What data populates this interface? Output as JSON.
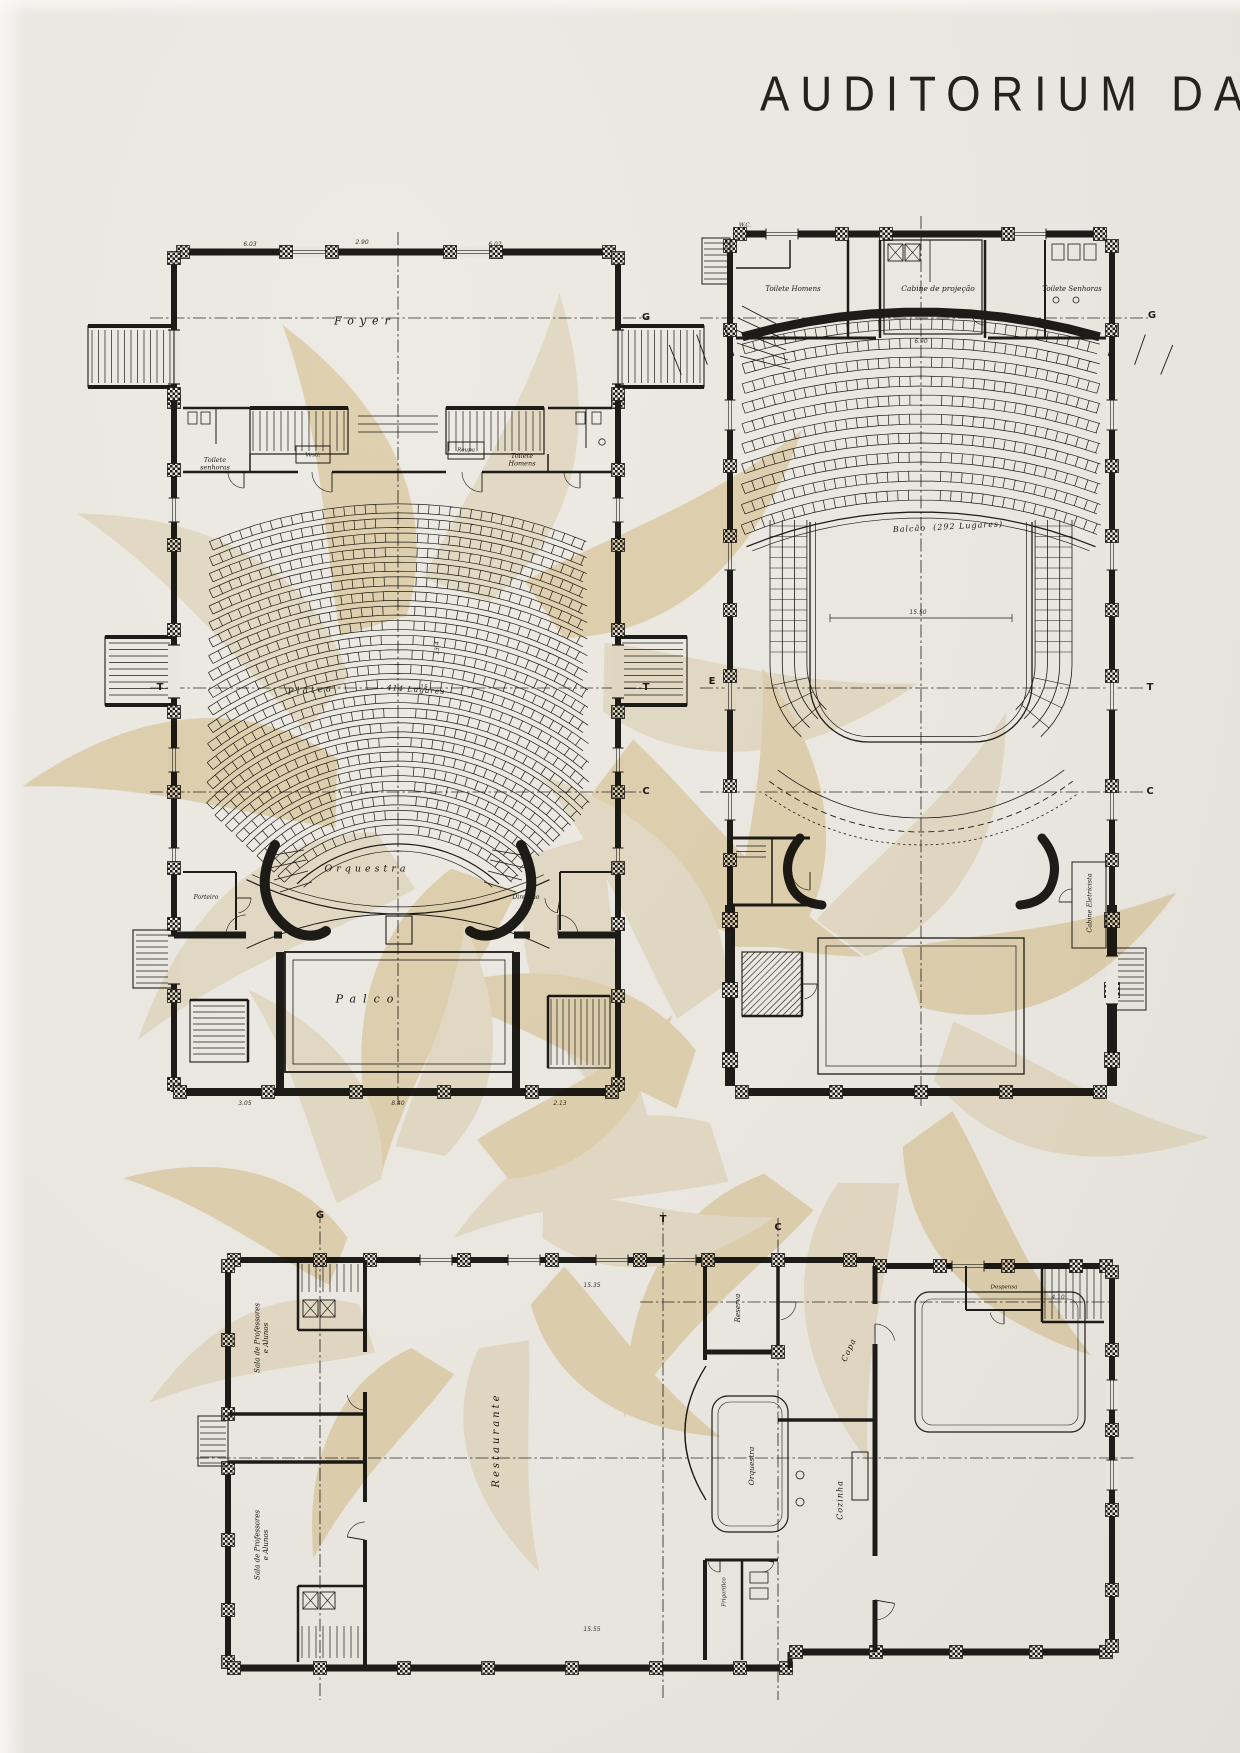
{
  "title": "AUDITORIUM DA",
  "colors": {
    "paper": "#e9e6e0",
    "ink": "#1d1c18",
    "section_line": "#2c2b26",
    "watermark_tan": "#efe1bf",
    "watermark_tan_light": "#f5edd9"
  },
  "plans": {
    "plan1": {
      "name": "planta-da-plateia",
      "labels": [
        {
          "id": "label-foyer",
          "t": "Foyer",
          "x": 365,
          "y": 322,
          "s": 11,
          "r": 0,
          "ls": 6
        },
        {
          "id": "label-toilete-senhoras",
          "t": "Toilete\nsenhoras",
          "x": 215,
          "y": 464,
          "s": 6.5,
          "r": 0,
          "ls": 0
        },
        {
          "id": "label-vesti",
          "t": "Vesti.",
          "x": 313,
          "y": 455,
          "s": 5.5,
          "r": 0,
          "ls": 0
        },
        {
          "id": "label-roupa",
          "t": "Roupa",
          "x": 466,
          "y": 450,
          "s": 5.5,
          "r": 0,
          "ls": 0
        },
        {
          "id": "label-toilete-homens",
          "t": "Toilete\nHomens",
          "x": 522,
          "y": 460,
          "s": 6.5,
          "r": 0,
          "ls": 0
        },
        {
          "id": "label-platea",
          "t": "Platea",
          "x": 311,
          "y": 691,
          "s": 9,
          "r": -4,
          "ls": 3
        },
        {
          "id": "label-platea-lugares",
          "t": "414 Lugares",
          "x": 416,
          "y": 690,
          "s": 7.5,
          "r": 4,
          "ls": 1
        },
        {
          "id": "label-orquestra",
          "t": "Orquestra",
          "x": 367,
          "y": 869,
          "s": 9.5,
          "r": 0,
          "ls": 4
        },
        {
          "id": "label-porteiro",
          "t": "Porteiro",
          "x": 206,
          "y": 897,
          "s": 6,
          "r": 0,
          "ls": 0
        },
        {
          "id": "label-direccao",
          "t": "Direcção",
          "x": 526,
          "y": 897,
          "s": 6,
          "r": 0,
          "ls": 0
        },
        {
          "id": "label-palco",
          "t": "Palco",
          "x": 368,
          "y": 1000,
          "s": 11,
          "r": 0,
          "ls": 7
        }
      ]
    },
    "plan2": {
      "name": "planta-do-balcao",
      "labels": [
        {
          "id": "label-wc",
          "t": "W.C.",
          "x": 745,
          "y": 225,
          "s": 5.5,
          "r": 0,
          "ls": 0
        },
        {
          "id": "label-toilete-homens-2",
          "t": "Toilete Homens",
          "x": 793,
          "y": 289,
          "s": 7,
          "r": 0,
          "ls": 0
        },
        {
          "id": "label-cabine-projecao",
          "t": "Cabine de projeção",
          "x": 938,
          "y": 289,
          "s": 7.5,
          "r": 0,
          "ls": 0
        },
        {
          "id": "label-toilete-senhoras-2",
          "t": "Toilete Senhoras",
          "x": 1072,
          "y": 289,
          "s": 7,
          "r": 0,
          "ls": 0
        },
        {
          "id": "label-balcao",
          "t": "Balcão  (292 Lugares)",
          "x": 948,
          "y": 527,
          "s": 8,
          "r": -3,
          "ls": 1
        },
        {
          "id": "label-cabine-eletricista",
          "t": "Cabine Eletricista",
          "x": 1090,
          "y": 903,
          "s": 6.5,
          "r": -90,
          "ls": 0
        }
      ]
    },
    "plan3": {
      "name": "planta-do-subsolo",
      "labels": [
        {
          "id": "label-sala-professores-1",
          "t": "Sala de Professores\ne Alunos",
          "x": 262,
          "y": 1338,
          "s": 7,
          "r": -90,
          "ls": 0
        },
        {
          "id": "label-sala-professores-2",
          "t": "Sala de Professores\ne Alunos",
          "x": 262,
          "y": 1545,
          "s": 7,
          "r": -90,
          "ls": 0
        },
        {
          "id": "label-restaurante",
          "t": "Restaurante",
          "x": 497,
          "y": 1440,
          "s": 10,
          "r": -90,
          "ls": 3
        },
        {
          "id": "label-reserva",
          "t": "Reserva",
          "x": 738,
          "y": 1308,
          "s": 7,
          "r": -90,
          "ls": 0
        },
        {
          "id": "label-copa",
          "t": "Copa",
          "x": 849,
          "y": 1350,
          "s": 8,
          "r": -65,
          "ls": 1
        },
        {
          "id": "label-orquestra-3",
          "t": "Orquestra",
          "x": 752,
          "y": 1466,
          "s": 7.5,
          "r": -90,
          "ls": 0
        },
        {
          "id": "label-cozinha",
          "t": "Cozinha",
          "x": 840,
          "y": 1500,
          "s": 8,
          "r": -90,
          "ls": 1
        },
        {
          "id": "label-despensa",
          "t": "Despensa",
          "x": 1004,
          "y": 1287,
          "s": 5.5,
          "r": 0,
          "ls": 0
        },
        {
          "id": "label-frigorifico",
          "t": "Frigorifico",
          "x": 724,
          "y": 1592,
          "s": 5.5,
          "r": -90,
          "ls": 0
        }
      ]
    }
  },
  "section_markers": [
    {
      "t": "G",
      "x": 646,
      "y": 318
    },
    {
      "t": "T",
      "x": 160,
      "y": 688
    },
    {
      "t": "T",
      "x": 646,
      "y": 688
    },
    {
      "t": "C",
      "x": 646,
      "y": 792
    },
    {
      "t": "G",
      "x": 1152,
      "y": 316
    },
    {
      "t": "E",
      "x": 712,
      "y": 682
    },
    {
      "t": "T",
      "x": 1150,
      "y": 688
    },
    {
      "t": "C",
      "x": 1150,
      "y": 792
    },
    {
      "t": "G",
      "x": 320,
      "y": 1216
    },
    {
      "t": "T",
      "x": 663,
      "y": 1220
    },
    {
      "t": "C",
      "x": 778,
      "y": 1228
    }
  ],
  "dimensions": [
    {
      "t": "6.03",
      "x": 250,
      "y": 244,
      "r": 0
    },
    {
      "t": "2.90",
      "x": 362,
      "y": 242,
      "r": 0
    },
    {
      "t": "6.02",
      "x": 495,
      "y": 244,
      "r": 0
    },
    {
      "t": "15",
      "x": 424,
      "y": 687,
      "r": 0
    },
    {
      "t": "13.4",
      "x": 437,
      "y": 648,
      "r": -90
    },
    {
      "t": "3.05",
      "x": 245,
      "y": 1103,
      "r": 0
    },
    {
      "t": "8.40",
      "x": 398,
      "y": 1103,
      "r": 0
    },
    {
      "t": "2.13",
      "x": 560,
      "y": 1103,
      "r": 0
    },
    {
      "t": "15.50",
      "x": 918,
      "y": 612,
      "r": 0
    },
    {
      "t": "6.90",
      "x": 921,
      "y": 341,
      "r": 0
    },
    {
      "t": "15.35",
      "x": 592,
      "y": 1285,
      "r": 0
    },
    {
      "t": "15.55",
      "x": 592,
      "y": 1629,
      "r": 0
    },
    {
      "t": "4.10",
      "x": 1058,
      "y": 1297,
      "r": 0
    }
  ]
}
